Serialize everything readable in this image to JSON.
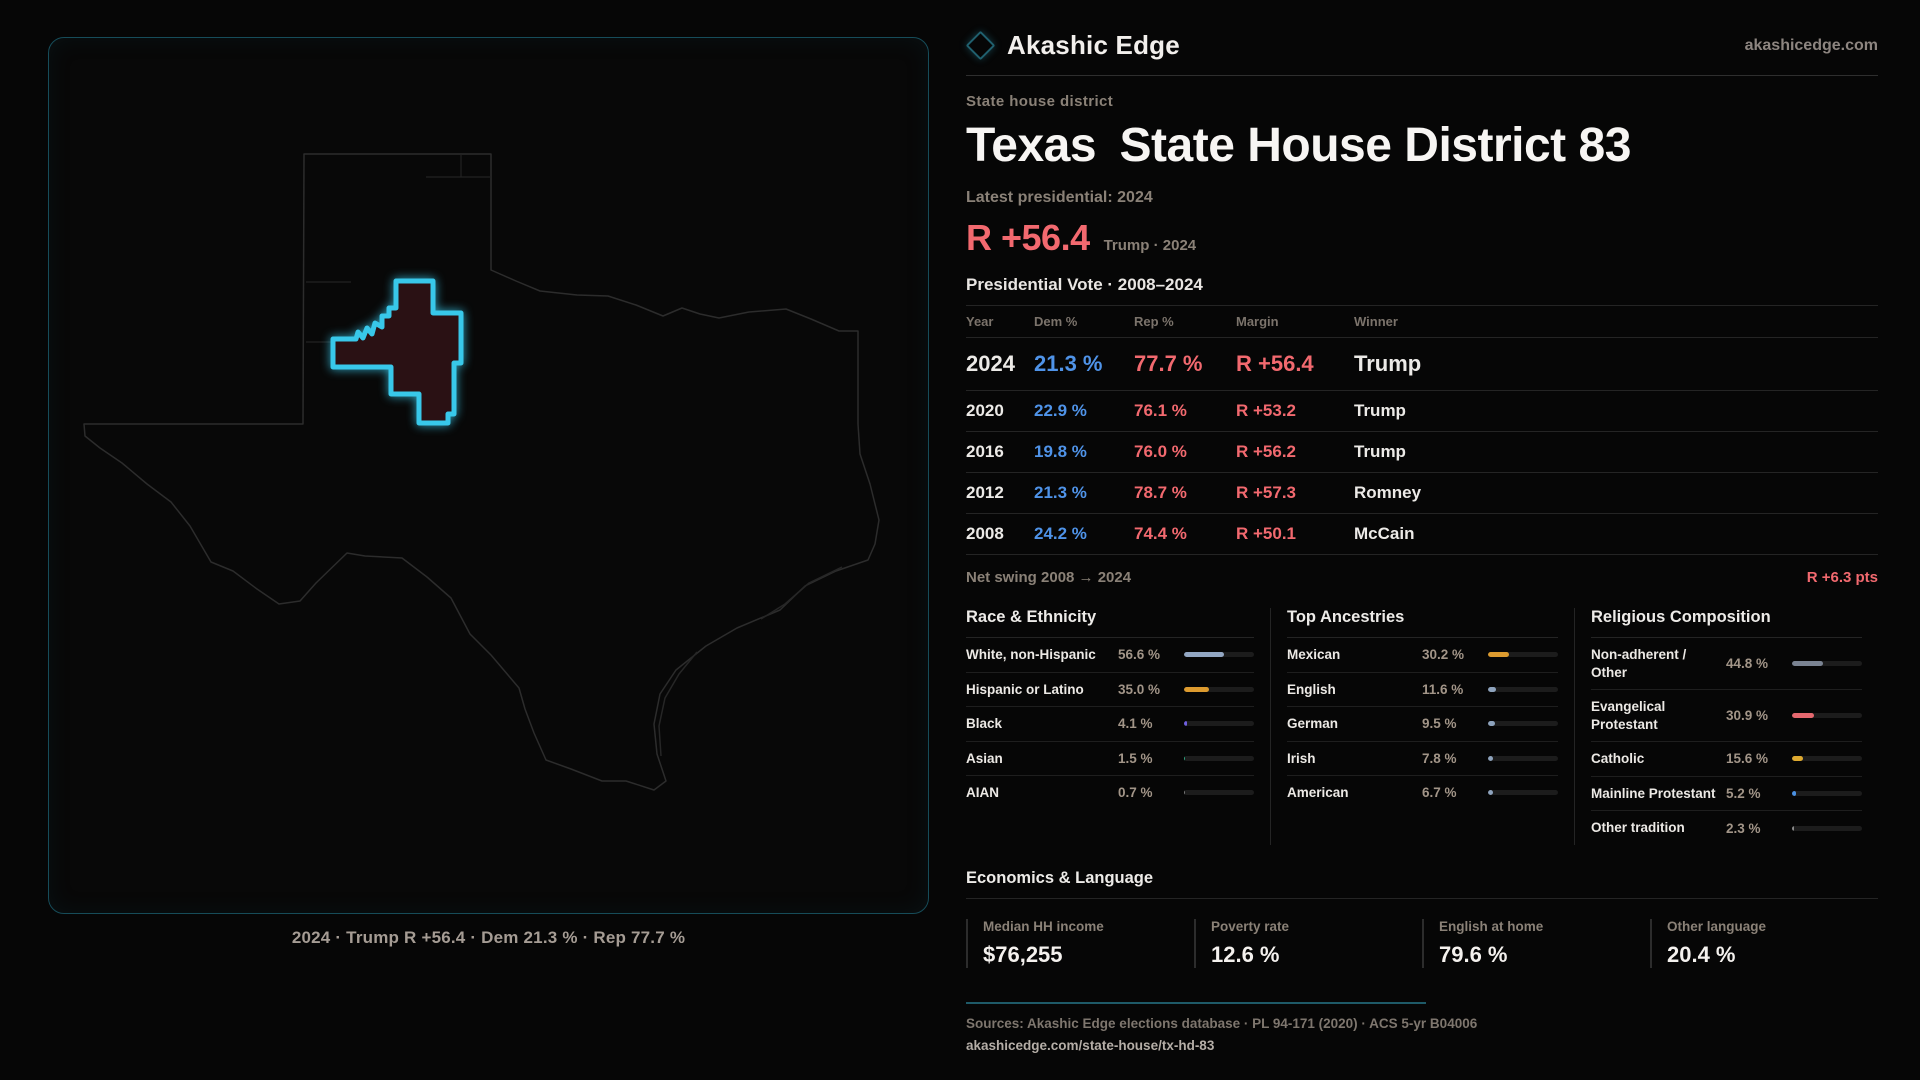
{
  "brand": {
    "name": "Akashic Edge",
    "domain": "akashicedge.com"
  },
  "page": {
    "kicker": "State house district",
    "title": "Texas State House District 83",
    "latest_label": "Latest presidential: 2024",
    "headline_margin": "R +56.4",
    "headline_context": "Trump · 2024"
  },
  "map": {
    "caption": "2024 · Trump R +56.4 · Dem 21.3 % · Rep 77.7 %",
    "district_outline_color": "#38c8ea",
    "district_fill_color": "#2a1114",
    "state_outline_color": "#2c2c2c"
  },
  "table": {
    "title": "Presidential Vote · 2008–2024",
    "columns": {
      "year": "Year",
      "dem": "Dem %",
      "rep": "Rep %",
      "margin": "Margin",
      "winner": "Winner"
    },
    "rows": [
      {
        "year": "2024",
        "dem": "21.3 %",
        "rep": "77.7 %",
        "margin": "R +56.4",
        "winner": "Trump"
      },
      {
        "year": "2020",
        "dem": "22.9 %",
        "rep": "76.1 %",
        "margin": "R +53.2",
        "winner": "Trump"
      },
      {
        "year": "2016",
        "dem": "19.8 %",
        "rep": "76.0 %",
        "margin": "R +56.2",
        "winner": "Trump"
      },
      {
        "year": "2012",
        "dem": "21.3 %",
        "rep": "78.7 %",
        "margin": "R +57.3",
        "winner": "Romney"
      },
      {
        "year": "2008",
        "dem": "24.2 %",
        "rep": "74.4 %",
        "margin": "R +50.1",
        "winner": "McCain"
      }
    ],
    "net_swing_label": "Net swing 2008 → 2024",
    "net_swing_value": "R +6.3 pts"
  },
  "panels": [
    {
      "title": "Race & Ethnicity",
      "rows": [
        {
          "label": "White, non-Hispanic",
          "value": "56.6 %",
          "pct": 56.6,
          "color": "#93a7c3"
        },
        {
          "label": "Hispanic or Latino",
          "value": "35.0 %",
          "pct": 35.0,
          "color": "#dd9b2f"
        },
        {
          "label": "Black",
          "value": "4.1 %",
          "pct": 4.1,
          "color": "#6f5fe0"
        },
        {
          "label": "Asian",
          "value": "1.5 %",
          "pct": 1.5,
          "color": "#2ea17d"
        },
        {
          "label": "AIAN",
          "value": "0.7 %",
          "pct": 0.7,
          "color": "#777777"
        }
      ]
    },
    {
      "title": "Top Ancestries",
      "rows": [
        {
          "label": "Mexican",
          "value": "30.2 %",
          "pct": 30.2,
          "color": "#dd9b2f"
        },
        {
          "label": "English",
          "value": "11.6 %",
          "pct": 11.6,
          "color": "#8ea3bd"
        },
        {
          "label": "German",
          "value": "9.5 %",
          "pct": 9.5,
          "color": "#8ea3bd"
        },
        {
          "label": "Irish",
          "value": "7.8 %",
          "pct": 7.8,
          "color": "#8ea3bd"
        },
        {
          "label": "American",
          "value": "6.7 %",
          "pct": 6.7,
          "color": "#8ea3bd"
        }
      ]
    },
    {
      "title": "Religious Composition",
      "rows": [
        {
          "label": "Non-adherent / Other",
          "value": "44.8 %",
          "pct": 44.8,
          "color": "#7a8392"
        },
        {
          "label": "Evangelical Protestant",
          "value": "30.9 %",
          "pct": 30.9,
          "color": "#e5686f"
        },
        {
          "label": "Catholic",
          "value": "15.6 %",
          "pct": 15.6,
          "color": "#deaa30"
        },
        {
          "label": "Mainline Protestant",
          "value": "5.2 %",
          "pct": 5.2,
          "color": "#4a90e2"
        },
        {
          "label": "Other tradition",
          "value": "2.3 %",
          "pct": 2.3,
          "color": "#8a8a8a"
        }
      ]
    }
  ],
  "economics": {
    "title": "Economics & Language",
    "stats": [
      {
        "label": "Median HH income",
        "value": "$76,255"
      },
      {
        "label": "Poverty rate",
        "value": "12.6 %"
      },
      {
        "label": "English at home",
        "value": "79.6 %"
      },
      {
        "label": "Other language",
        "value": "20.4 %"
      }
    ]
  },
  "footer": {
    "sources": "Sources: Akashic Edge elections database · PL 94-171 (2020) · ACS 5-yr B04006",
    "link": "akashicedge.com/state-house/tx-hd-83"
  },
  "colors": {
    "dem": "#4f93e8",
    "rep": "#f2696f",
    "accent_teal": "#1e5a68"
  }
}
